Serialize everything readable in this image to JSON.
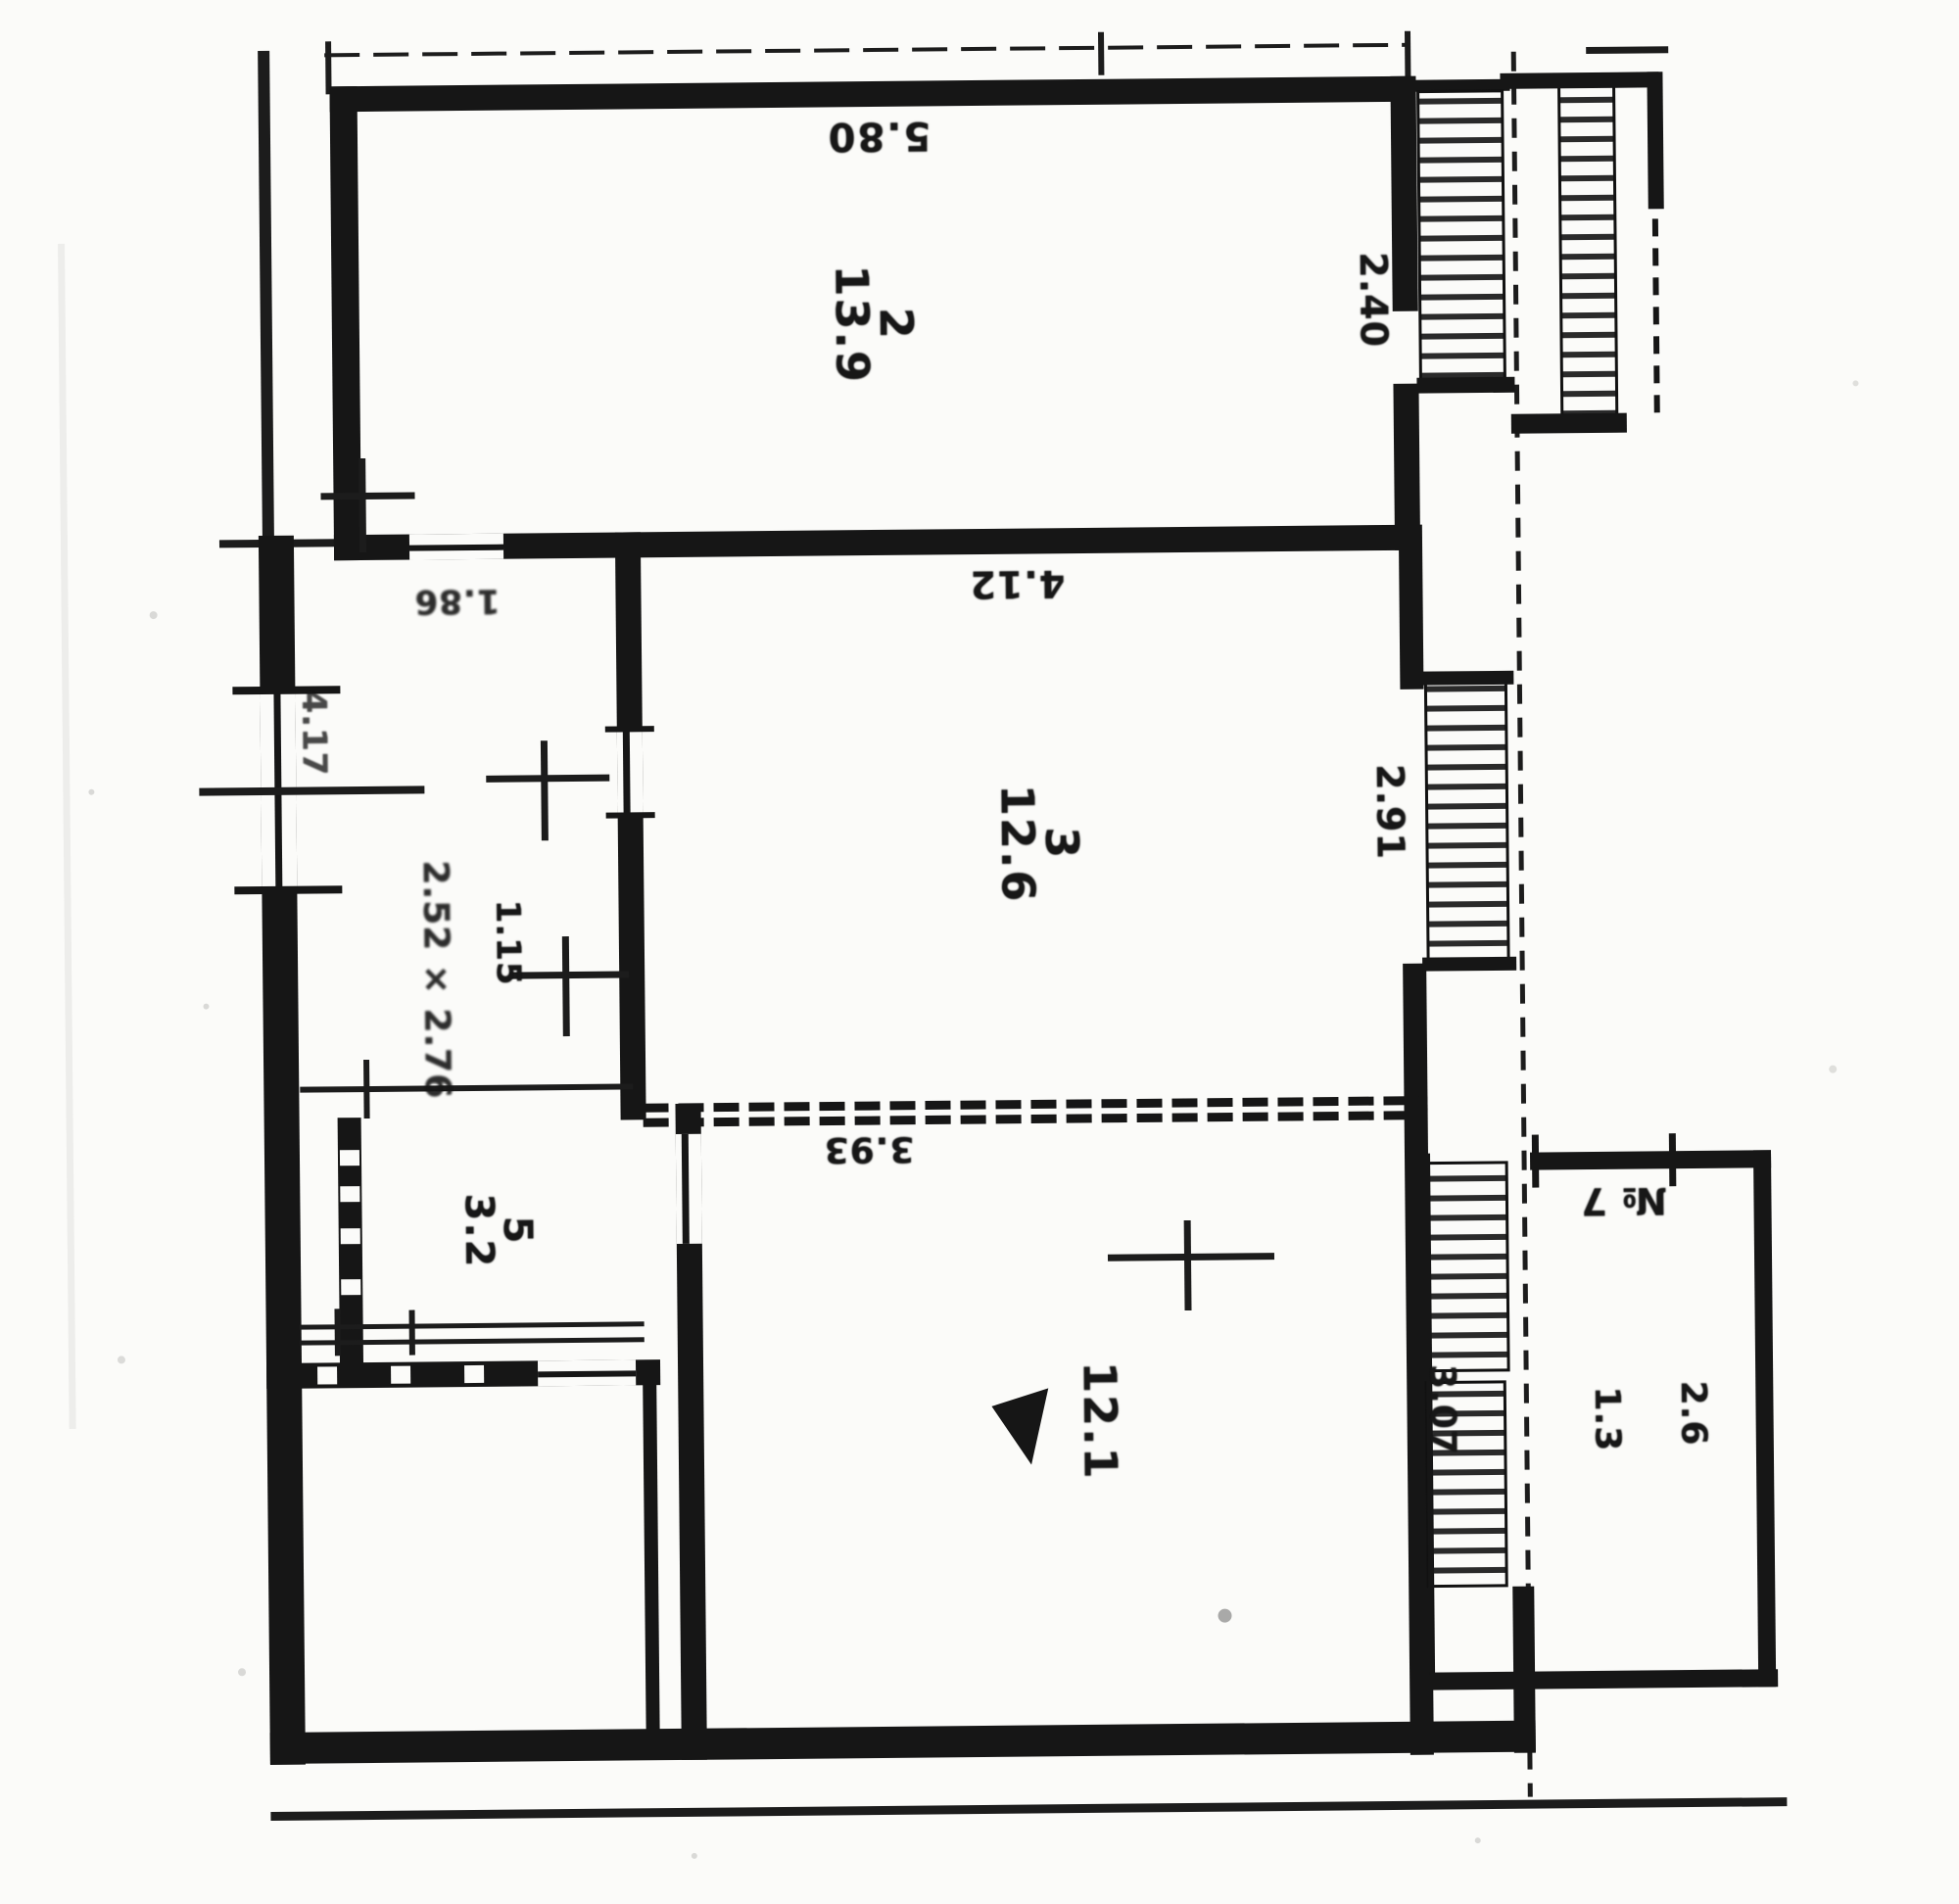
{
  "plan": {
    "rooms": [
      {
        "number": "2",
        "area": "13.9"
      },
      {
        "number": "3",
        "area": "12.6"
      },
      {
        "number": "",
        "area": "12.1",
        "marker": "triangle-icon"
      },
      {
        "number": "5",
        "area": "3.2"
      }
    ],
    "annex": {
      "number_label": "№ 7",
      "dims": [
        "1.3",
        "2.6"
      ]
    },
    "dimensions": {
      "top_width": "5.80",
      "room2_window": "2.40",
      "room3_width": "4.12",
      "room3_window": "2.91",
      "room1_width": "3.93",
      "room1_right": "3.07",
      "hall_passage": "1.15",
      "hall_top": "1.86",
      "left_wall": "4.17",
      "hall_size": "2.52 × 2.76"
    },
    "colors": {
      "ink": "#161616",
      "paper": "#fbfbf9"
    }
  }
}
